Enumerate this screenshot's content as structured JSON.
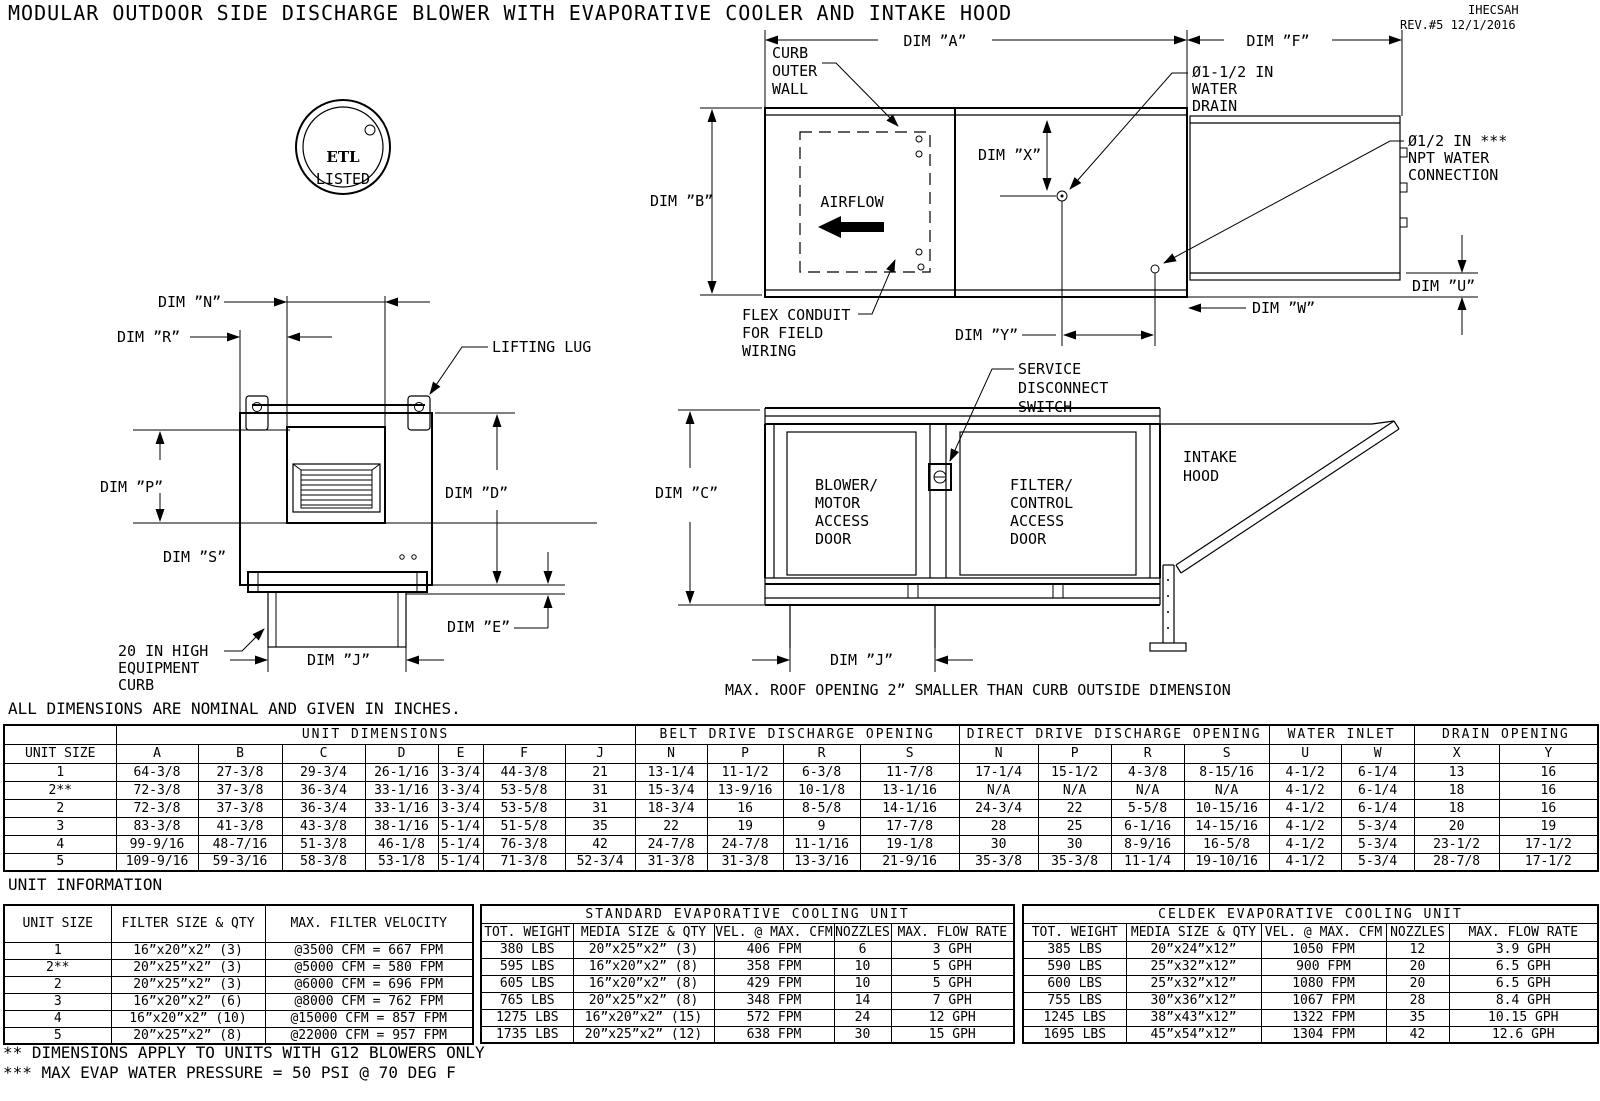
{
  "header": {
    "title": "MODULAR OUTDOOR SIDE DISCHARGE BLOWER WITH EVAPORATIVE COOLER AND INTAKE HOOD",
    "doc_code": "IHECSAH",
    "revision": "REV.#5  12/1/2016"
  },
  "notes": {
    "dims_note": "ALL DIMENSIONS ARE NOMINAL AND GIVEN IN INCHES.",
    "unit_info_heading": "UNIT INFORMATION",
    "footnote_2": "** DIMENSIONS APPLY TO UNITS WITH G12 BLOWERS ONLY",
    "footnote_3": "*** MAX EVAP WATER PRESSURE = 50 PSI @ 70 DEG F",
    "roof_note": "MAX. ROOF OPENING 2” SMALLER THAN CURB OUTSIDE DIMENSION"
  },
  "drawings": {
    "etl": {
      "logo_text": "ETL",
      "listed": "LISTED"
    },
    "plan": {
      "dim_a": "DIM ”A”",
      "dim_f": "DIM ”F”",
      "dim_b": "DIM ”B”",
      "dim_x": "DIM ”X”",
      "dim_y": "DIM ”Y”",
      "dim_w": "DIM ”W”",
      "dim_u": "DIM ”U”",
      "curb_label": [
        "CURB",
        "OUTER",
        "WALL"
      ],
      "airflow": "AIRFLOW",
      "flex_label": [
        "FLEX CONDUIT",
        "FOR FIELD",
        "WIRING"
      ],
      "drain_label": [
        "Ø1-1/2 IN",
        "WATER",
        "DRAIN"
      ],
      "npt_label": [
        "Ø1/2 IN ***",
        "NPT WATER",
        "CONNECTION"
      ]
    },
    "front": {
      "dim_n": "DIM ”N”",
      "dim_r": "DIM ”R”",
      "dim_p": "DIM ”P”",
      "dim_s": "DIM ”S”",
      "dim_d": "DIM ”D”",
      "dim_e": "DIM ”E”",
      "dim_j": "DIM ”J”",
      "lifting_lug": "LIFTING LUG",
      "curb_label": [
        "20 IN HIGH",
        "EQUIPMENT",
        "CURB"
      ]
    },
    "side": {
      "dim_c": "DIM ”C”",
      "dim_j": "DIM ”J”",
      "switch_label": [
        "SERVICE",
        "DISCONNECT",
        "SWITCH"
      ],
      "blower_door": [
        "BLOWER/",
        "MOTOR",
        "ACCESS",
        "DOOR"
      ],
      "filter_door": [
        "FILTER/",
        "CONTROL",
        "ACCESS",
        "DOOR"
      ],
      "hood_label": [
        "INTAKE",
        "HOOD"
      ]
    }
  },
  "dims_table": {
    "groups": {
      "unit_dimensions": "UNIT DIMENSIONS",
      "belt": "BELT DRIVE DISCHARGE OPENING",
      "direct": "DIRECT DRIVE DISCHARGE OPENING",
      "water": "WATER INLET",
      "drain": "DRAIN OPENING"
    },
    "columns": [
      "UNIT SIZE",
      "A",
      "B",
      "C",
      "D",
      "E",
      "F",
      "J",
      "N",
      "P",
      "R",
      "S",
      "N",
      "P",
      "R",
      "S",
      "U",
      "W",
      "X",
      "Y"
    ],
    "rows": [
      [
        "1",
        "64-3/8",
        "27-3/8",
        "29-3/4",
        "26-1/16",
        "3-3/4",
        "44-3/8",
        "21",
        "13-1/4",
        "11-1/2",
        "6-3/8",
        "11-7/8",
        "17-1/4",
        "15-1/2",
        "4-3/8",
        "8-15/16",
        "4-1/2",
        "6-1/4",
        "13",
        "16"
      ],
      [
        "2**",
        "72-3/8",
        "37-3/8",
        "36-3/4",
        "33-1/16",
        "3-3/4",
        "53-5/8",
        "31",
        "15-3/4",
        "13-9/16",
        "10-1/8",
        "13-1/16",
        "N/A",
        "N/A",
        "N/A",
        "N/A",
        "4-1/2",
        "6-1/4",
        "18",
        "16"
      ],
      [
        "2",
        "72-3/8",
        "37-3/8",
        "36-3/4",
        "33-1/16",
        "3-3/4",
        "53-5/8",
        "31",
        "18-3/4",
        "16",
        "8-5/8",
        "14-1/16",
        "24-3/4",
        "22",
        "5-5/8",
        "10-15/16",
        "4-1/2",
        "6-1/4",
        "18",
        "16"
      ],
      [
        "3",
        "83-3/8",
        "41-3/8",
        "43-3/8",
        "38-1/16",
        "5-1/4",
        "51-5/8",
        "35",
        "22",
        "19",
        "9",
        "17-7/8",
        "28",
        "25",
        "6-1/16",
        "14-15/16",
        "4-1/2",
        "5-3/4",
        "20",
        "19"
      ],
      [
        "4",
        "99-9/16",
        "48-7/16",
        "51-3/8",
        "46-1/8",
        "5-1/4",
        "76-3/8",
        "42",
        "24-7/8",
        "24-7/8",
        "11-1/16",
        "19-1/8",
        "30",
        "30",
        "8-9/16",
        "16-5/8",
        "4-1/2",
        "5-3/4",
        "23-1/2",
        "17-1/2"
      ],
      [
        "5",
        "109-9/16",
        "59-3/16",
        "58-3/8",
        "53-1/8",
        "5-1/4",
        "71-3/8",
        "52-3/4",
        "31-3/8",
        "31-3/8",
        "13-3/16",
        "21-9/16",
        "35-3/8",
        "35-3/8",
        "11-1/4",
        "19-10/16",
        "4-1/2",
        "5-3/4",
        "28-7/8",
        "17-1/2"
      ]
    ]
  },
  "info_left": {
    "columns": [
      "UNIT SIZE",
      "FILTER SIZE & QTY",
      "MAX. FILTER VELOCITY"
    ],
    "rows": [
      [
        "1",
        "16”x20”x2” (3)",
        "@3500 CFM = 667 FPM"
      ],
      [
        "2**",
        "20”x25”x2” (3)",
        "@5000 CFM = 580 FPM"
      ],
      [
        "2",
        "20”x25”x2” (3)",
        "@6000 CFM = 696 FPM"
      ],
      [
        "3",
        "16”x20”x2” (6)",
        "@8000 CFM = 762 FPM"
      ],
      [
        "4",
        "16”x20”x2” (10)",
        "@15000 CFM = 857 FPM"
      ],
      [
        "5",
        "20”x25”x2” (8)",
        "@22000 CFM = 957 FPM"
      ]
    ]
  },
  "info_standard": {
    "title": "STANDARD EVAPORATIVE COOLING UNIT",
    "columns": [
      "TOT. WEIGHT",
      "MEDIA SIZE & QTY",
      "VEL. @ MAX. CFM",
      "NOZZLES",
      "MAX. FLOW RATE"
    ],
    "rows": [
      [
        "380 LBS",
        "20”x25”x2” (3)",
        "406 FPM",
        "6",
        "3 GPH"
      ],
      [
        "595 LBS",
        "16”x20”x2” (8)",
        "358 FPM",
        "10",
        "5 GPH"
      ],
      [
        "605 LBS",
        "16”x20”x2” (8)",
        "429 FPM",
        "10",
        "5 GPH"
      ],
      [
        "765 LBS",
        "20”x25”x2” (8)",
        "348 FPM",
        "14",
        "7 GPH"
      ],
      [
        "1275 LBS",
        "16”x20”x2” (15)",
        "572 FPM",
        "24",
        "12 GPH"
      ],
      [
        "1735 LBS",
        "20”x25”x2” (12)",
        "638 FPM",
        "30",
        "15 GPH"
      ]
    ]
  },
  "info_celdek": {
    "title": "CELDEK EVAPORATIVE COOLING UNIT",
    "columns": [
      "TOT. WEIGHT",
      "MEDIA SIZE & QTY",
      "VEL. @ MAX. CFM",
      "NOZZLES",
      "MAX. FLOW RATE"
    ],
    "rows": [
      [
        "385 LBS",
        "20”x24”x12”",
        "1050 FPM",
        "12",
        "3.9 GPH"
      ],
      [
        "590 LBS",
        "25”x32”x12”",
        "900 FPM",
        "20",
        "6.5 GPH"
      ],
      [
        "600 LBS",
        "25”x32”x12”",
        "1080 FPM",
        "20",
        "6.5 GPH"
      ],
      [
        "755 LBS",
        "30”x36”x12”",
        "1067 FPM",
        "28",
        "8.4 GPH"
      ],
      [
        "1245 LBS",
        "38”x43”x12”",
        "1322 FPM",
        "35",
        "10.15 GPH"
      ],
      [
        "1695 LBS",
        "45”x54”x12”",
        "1304 FPM",
        "42",
        "12.6 GPH"
      ]
    ]
  }
}
